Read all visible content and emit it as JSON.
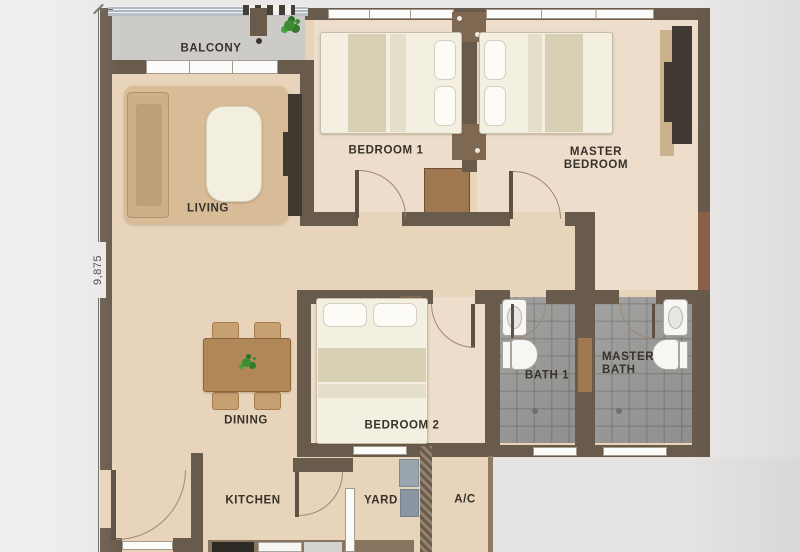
{
  "plan": {
    "dimension": {
      "height_label": "9,875"
    },
    "rooms": {
      "balcony": "BALCONY",
      "living": "LIVING",
      "bedroom1": "BEDROOM 1",
      "master_bedroom": {
        "line1": "MASTER",
        "line2": "BEDROOM"
      },
      "dining": "DINING",
      "bedroom2": "BEDROOM 2",
      "bath1": "BATH 1",
      "master_bath": {
        "line1": "MASTER",
        "line2": "BATH"
      },
      "kitchen": "KITCHEN",
      "yard": "YARD",
      "ac": "A/C"
    },
    "colors": {
      "wall": "#695b4c",
      "floor_main": "#e8d4ba",
      "floor_bedroom": "#edddca",
      "floor_bath_tile": "#9b9b99",
      "floor_balcony": "#cdcbc7",
      "background": "#eae9e7",
      "accent_wood": "#9f7750",
      "accent_red_wall": "#8d6049",
      "plant_green": "#3c8c34",
      "appliance_gray": "#9aa5ae"
    }
  }
}
